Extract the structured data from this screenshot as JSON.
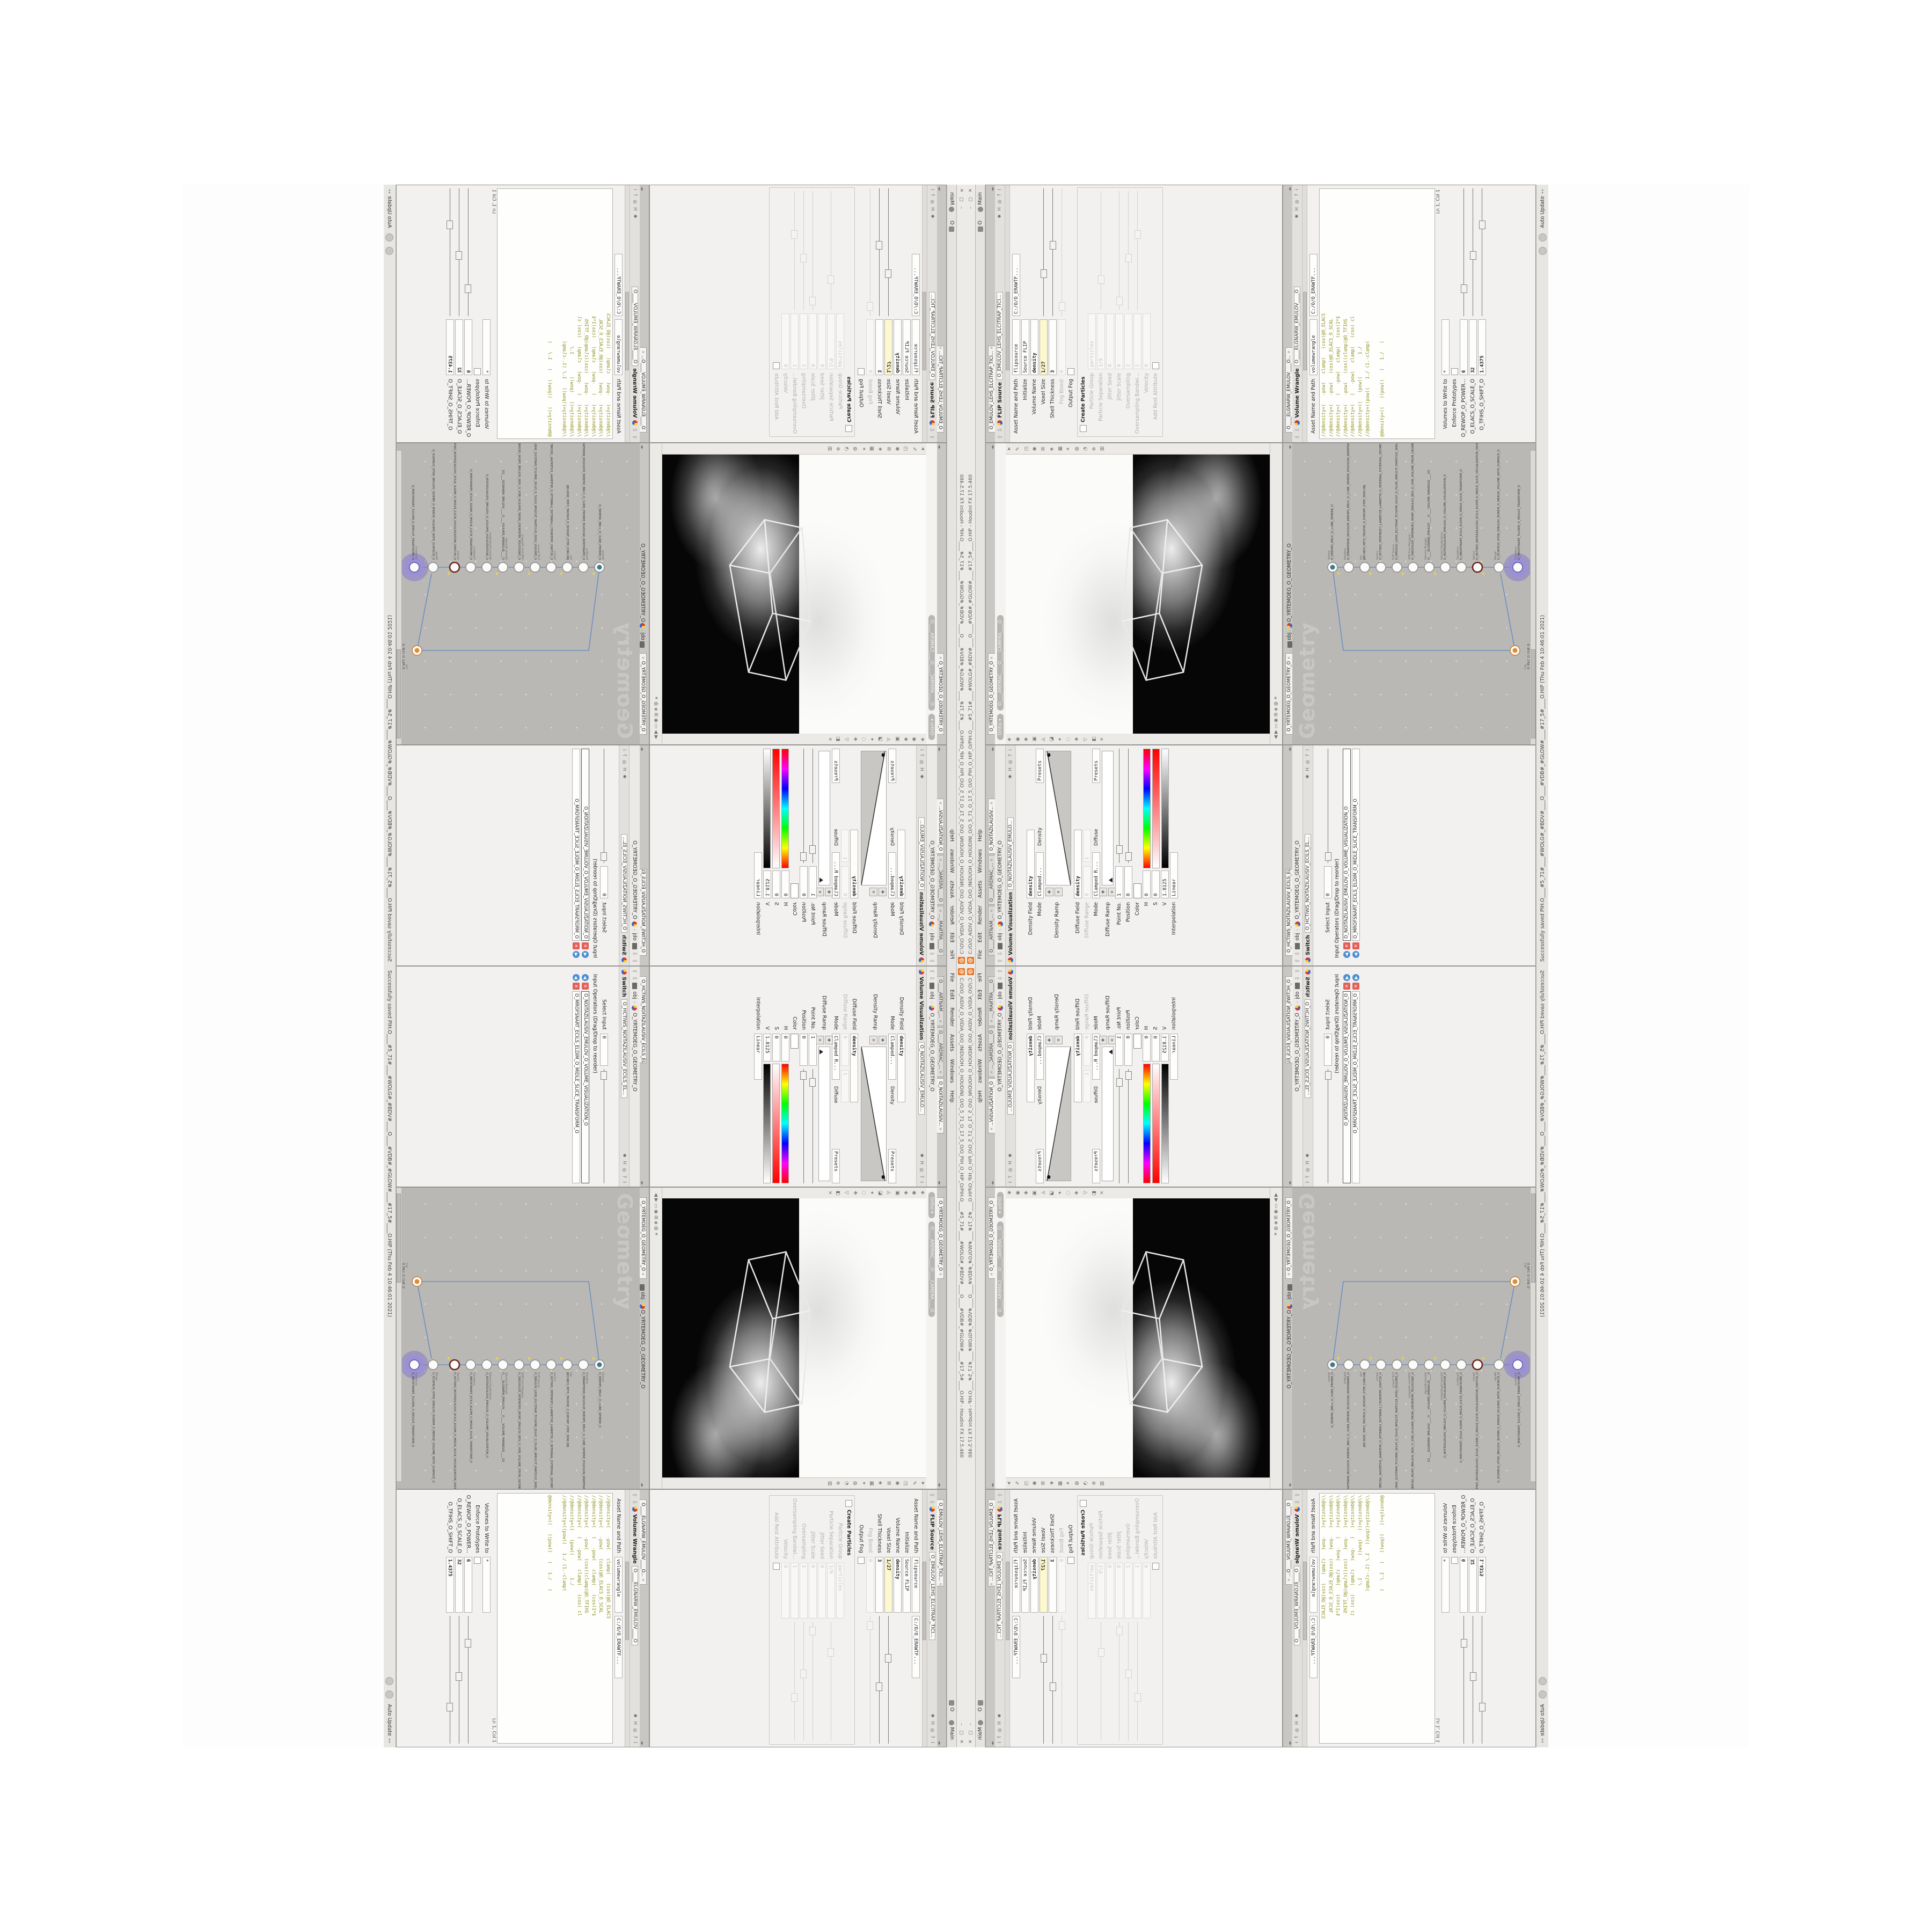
{
  "window": {
    "title": "C:/O/O_AIDIV_O_VIDIA_O/O_INIDUOH_O_HOUDINI_O/O_5_71_O_17_5_O/O_PIH_O_HIP_O/PIH.O____#5_71#____#WOLG#_#BDV#____O____#VDB#_#GLOW#____#17_5#____O.HIP - Houdini FX 17.5.460",
    "logo_glyph": "@",
    "menu": [
      "File",
      "Edit",
      "Render",
      "Assets",
      "Windows",
      "Help"
    ],
    "menu_extra": "O",
    "desktop_tab": "Main",
    "win_buttons": "– ▢ ✕"
  },
  "status": {
    "message": "Successfully saved PIH.O____#5_71#____#WOLG#_#BDV#____O____#VDB#_#GLOW#____#17_5#____O.HIP  (Thu Feb 4 10:46:01 2021)",
    "mode": "Auto Update",
    "spinner": "◂ ▸"
  },
  "path": {
    "root": "obj",
    "geo": "O_YRTEMOEG_O_GEOMETRY_O"
  },
  "header_icons": "✱ H ◎ ? i",
  "tab_close": "✕",
  "panes": {
    "volvis": {
      "tabs": [
        "O____ARTNAM_...",
        "O____AREMAC_...",
        "O_NOITAZILAUSIV..."
      ],
      "title": "Volume Visualization",
      "node": "O_NOITAZILAUSIV_EMULO...",
      "density_field_label": "Density Field",
      "density_field": "density",
      "mode_label": "Mode",
      "mode": "Clamped...",
      "density_group": "Density",
      "presets": "Presets",
      "density_ramp_label": "Density Ramp",
      "diffuse_field_label": "Diffuse Field",
      "diffuse_field": "density",
      "diffuse_range_label": "Diffuse Range",
      "diffuse_range_min": "0",
      "diffuse_range_max": "1",
      "mode2_label": "Mode",
      "mode2": "Clamped R...",
      "diffuse_group": "Diffuse",
      "diffuse_ramp_label": "Diffuse Ramp",
      "point_label": "Point No.",
      "point": "1",
      "position_label": "Position",
      "position": "0",
      "color_label": "Color",
      "h_label": "H",
      "h": "0",
      "s_label": "S",
      "s": "0",
      "v_label": "V",
      "v": "1.8125",
      "interp_label": "Interpolation",
      "interp": "Linear"
    },
    "switch": {
      "tabs": [
        "O_HCTIWS_NOITAZILAUSIV_ECILS_EL..."
      ],
      "title": "Switch",
      "node": "O_HCTIWS_NOITAZILAUSIV_ECILS_EL...",
      "select_label": "Select Input",
      "select": "0",
      "list_label": "Input Operators (Drag/Drop to reorder)",
      "items": [
        "O_NOITAZILAUSIV_EMULOV_O_VOLUME_VISUALIZATION_O",
        "O_MROFSNART_ECILS_ELDIM_O_MIDLE_SLICE_TRANSFORM_O"
      ]
    },
    "flip": {
      "tabs": [
        "O_EMULOV_LEHS_ELCITRAP_TICI..."
      ],
      "title": "FLIP Source",
      "node": "O_EMULOV_LEHS_ELCITRAP_TICI...",
      "asset_label": "Asset Name and Path",
      "asset_name": "flipsource",
      "asset_path": "C:/O/O_ERAWTF...",
      "initialize_label": "Initialize",
      "initialize": "Source FLIP",
      "volname_label": "Volume Name",
      "volname": "density",
      "voxel_label": "Voxel Size",
      "voxel": "1/27",
      "shell_label": "Shell Thickness",
      "shell": "3",
      "fog_label": "Fog Boost",
      "fog": "0",
      "outputfog_label": "Output Fog",
      "particles_group": "Particles",
      "create_label": "Create Particles",
      "pgroup_label": "Particle Group",
      "pgroup": "particles",
      "psep_label": "Particle Separation",
      "psep": "1/9",
      "jseed_label": "Jitter Seed",
      "jseed": "0",
      "jscale_label": "Jitter Scale",
      "jscale": "0",
      "oversamp_label": "Oversampling",
      "oversamp": "2",
      "oband_label": "Oversampling Bandwi...",
      "oband": "1",
      "vel_label": "Velocity",
      "vel": "0",
      "rest_label": "Add Rest Attribute"
    },
    "wrangle": {
      "tabs": [
        "O____ELGNARW_EMULOV____O..."
      ],
      "title": "Volume Wrangle",
      "node": "O____ELGNARW_EMULOV____O",
      "asset_label": "Asset Name and Path",
      "asset_name": "volumewrangle",
      "asset_path": "C:/O/O_ERAWTF...",
      "code": "//@density=(   -pow(   clamp(   (cos(@O_ELACS\n//@density=(   -pow(   (cos(@O_ELACS_O_SCAL\n//@density=(   (   -pow(   clamp(   (cos(1*$\n//@density=(   -pow(   (cos((clamp(@O_TFIHS\n//@density=(   (   -pow(   clamp(   (cos( cl\n//@density=((   (pow((        1./\n//@density=((pow((   1./ (1.-clamp(\n\n@density=((   ((pow((   (   1./   (",
      "lncol": "Ln 1, Col 1",
      "volumes_label": "Volumes to Write to",
      "volumes": "*",
      "enforce_label": "Enforce Prototypes",
      "power_label": "O_REWOP_O_POWER...",
      "power": "6",
      "scale_label": "O_ELACS_O_SCALE_O",
      "scale": "32",
      "shift_label": "O_TFIHS_O_SHIFT_O",
      "shift": "1.4375"
    }
  },
  "viewport": {
    "tab": "O_YRTEMOEG_O_GEOMETRY_O",
    "ortho": "Ortho ▾",
    "camera": "O____AREMAC____O____CAMERA____O",
    "left_icons": "◈\n◉\n✚\n▣\n◬\n◪\n✦\n◌\n❖\n▽\n◧\n✕",
    "right_icons": "➤\n✎\n◳\n◉\n⊞\n◈\n▦\n✶\n◍\n◔\n⊕\n▥",
    "bot_icons": "◀  ▶    ▭  ◉  ⊞    ◈  ◍  ✶"
  },
  "network": {
    "tab": "O_YRTEMOEG_O_GEOMETRY_O",
    "watermark": "Geometry",
    "nodes": [
      {
        "t": "Sphere",
        "n": "O_EREHPS_EBUC_O_CUBE_SPHERE_O"
      },
      {
        "t": "PolyWire",
        "n": "O_EMARFERIW_NOGYLOP_EREHPS_EBUC_O_CUBE_SPHERE_POLYGON_WIREFRAME_O"
      },
      {
        "t": "File",
        "n": "JBO.MD3_PETS_TROPXE_O_EXPORT_STEP_3DM.OBJ"
      },
      {
        "t": "Switch",
        "n": "O_HCTIWS_YRTEMOEG_LANRETXE_LANRETNI_O_INTERNAL_EXTERNAL_GEOMETRY_SWITCH_O"
      },
      {
        "t": "FLIP Source",
        "n": "O_EMULOV_LEHS_ELCITRAP_TICILPMI_DIULF_O_FLUID_IMPLICIT_PARTICLE_SHEL_VOLUME_O"
      },
      {
        "t": "VDB from Polygons",
        "n": "O_SNOGYLOP_YRTEMOEG_MORF_EMULOV_BDV_O_VDB_VOLUME_FROM_GEOMETRY_POLYGONS_O"
      },
      {
        "t": "Volume Wrangle",
        "n": "O____ELGNARW_EMULOV____O____VOLUME_WRANGLE____O2"
      },
      {
        "t": "Volume Visualization",
        "n": "O_NOITAZILAUSIV_EMULOV_O_VOLUME_VISUALIZATION_O"
      },
      {
        "t": "Transform",
        "n": "O_MROFSNART_ECILS_ELDIM_O_MIDLE_SLICE_TRANSFORM_O"
      },
      {
        "t": "Switch",
        "n": "O_HCTIWS_NOITAZILAUSIV_ECILS_ELDIM_O_MIDLE_SLICE_VISUALIZATION_SWITCH_O"
      },
      {
        "t": "Merge",
        "n": "O_ECAFRUS_HTIW_EMULOV_EGREM_O_MERGE_VOLUME_WITH_SURFACE_O"
      },
      {
        "t": "Transform",
        "n": "O_MROFSNART_TLUSER_O_RESULT_TRANSFORM_O"
      },
      {
        "t": "Clip",
        "n": "O_PILC_O_CLIP_O"
      }
    ]
  }
}
